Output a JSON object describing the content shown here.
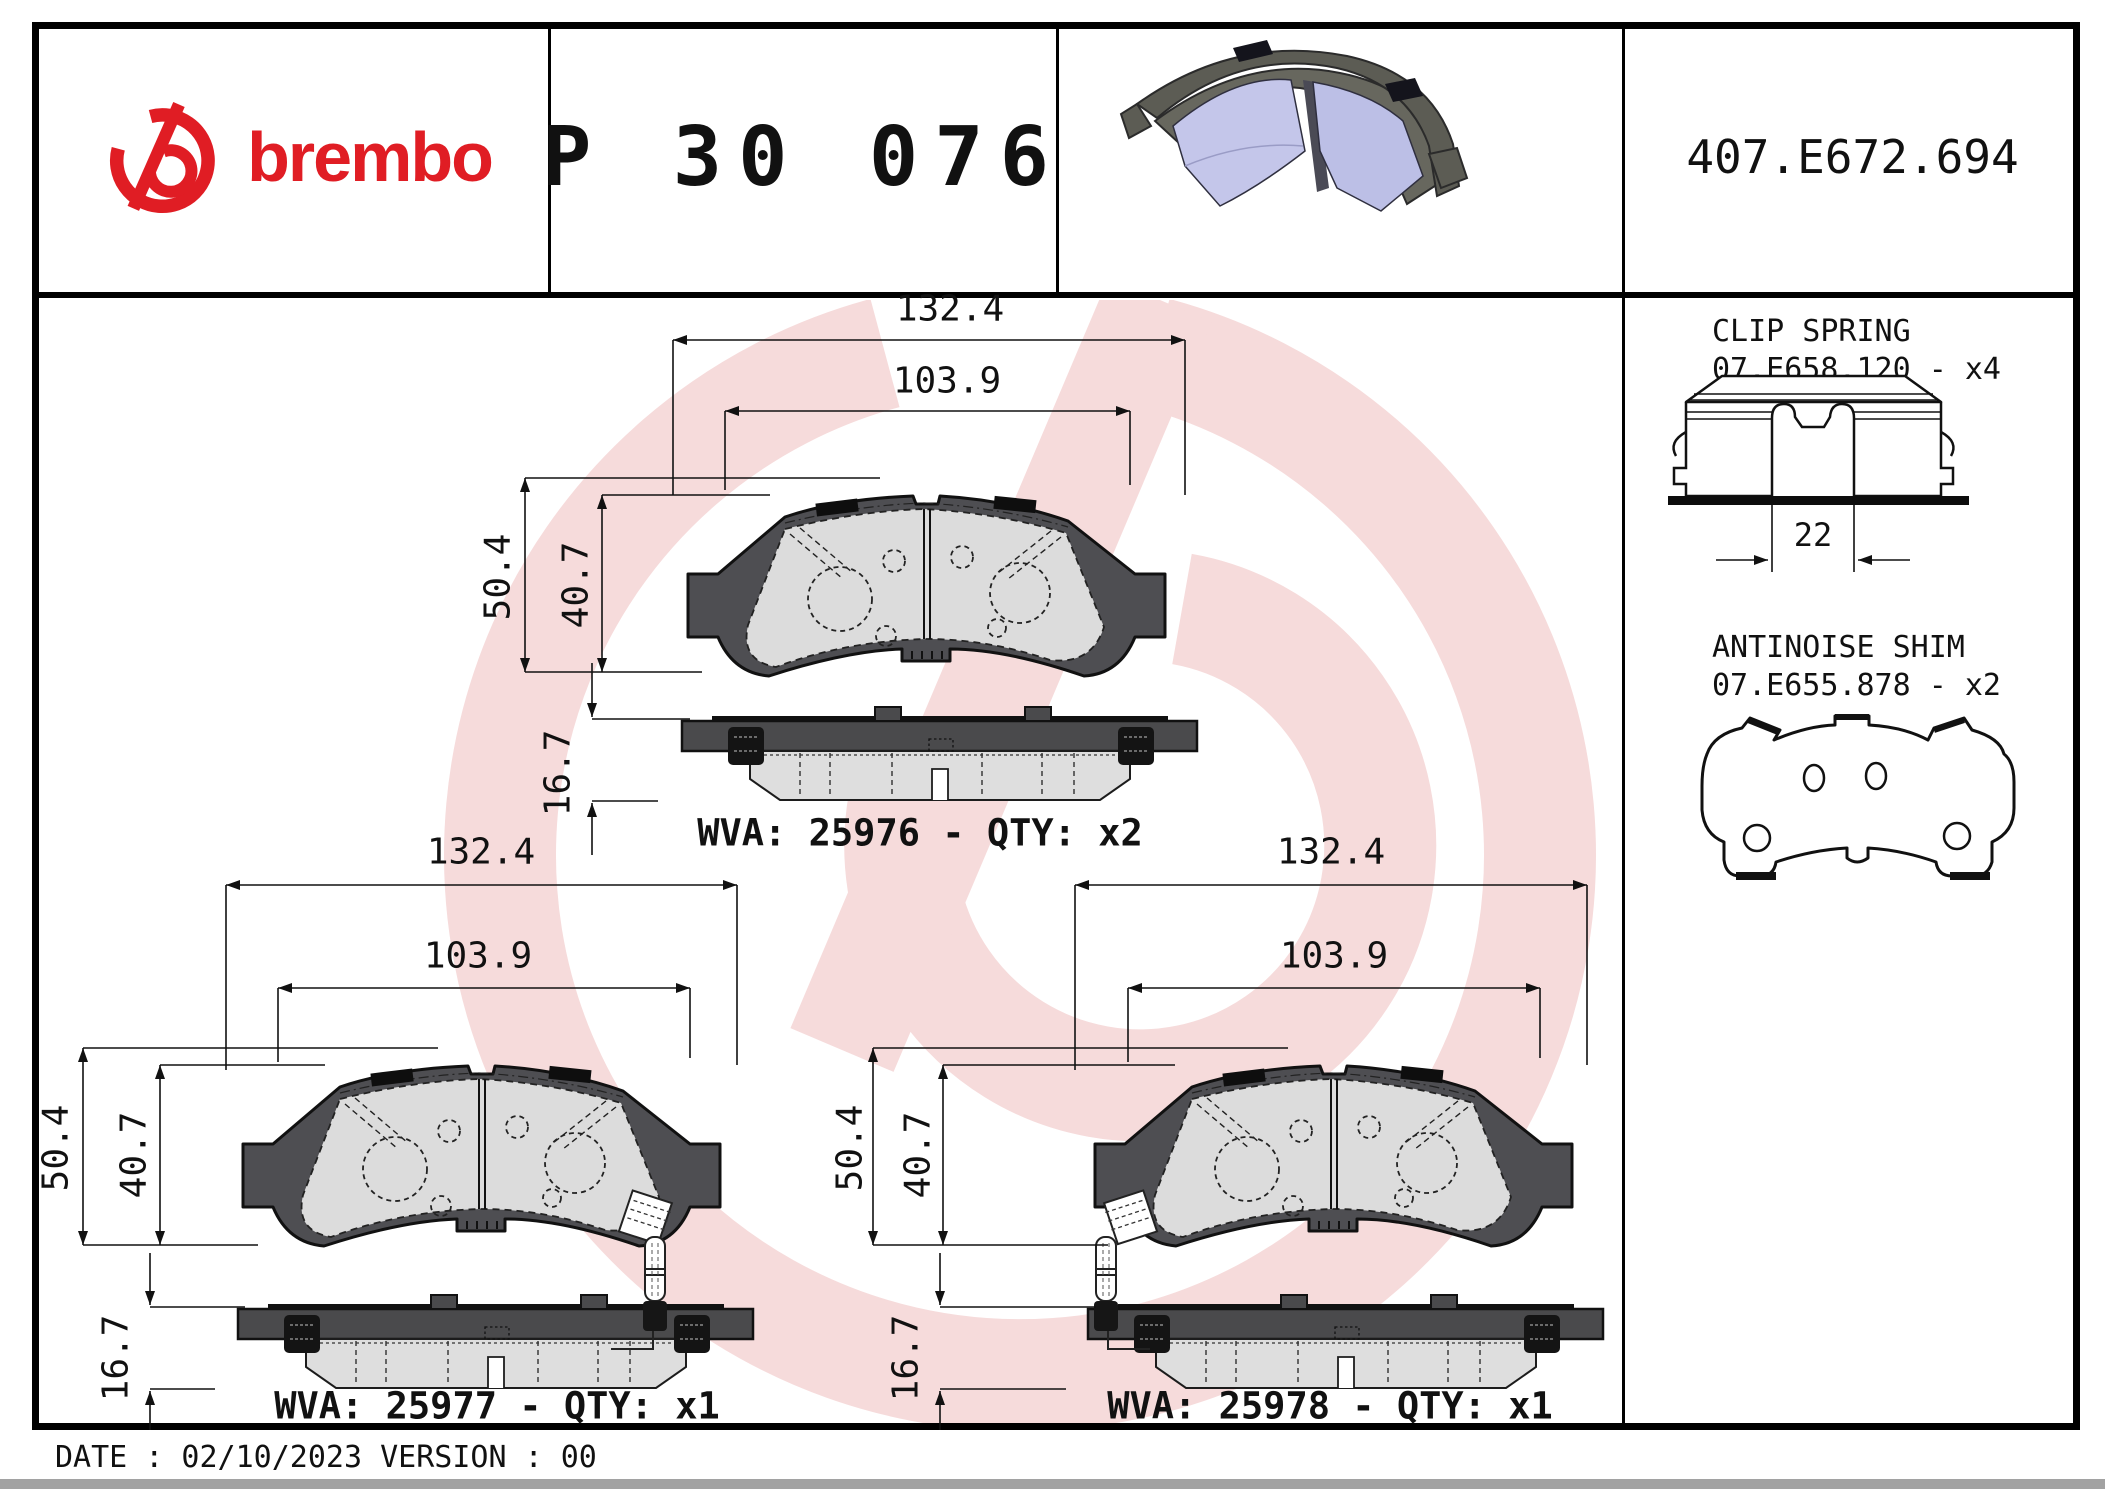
{
  "header": {
    "brand_wordmark": "brembo",
    "part_number": "P 30 076",
    "catalog_code": "407.E672.694"
  },
  "sidebar": {
    "clip_spring": {
      "title": "CLIP SPRING",
      "code": "07.E658.120 - x4",
      "slot_width": "22"
    },
    "antinoise_shim": {
      "title": "ANTINOISE SHIM",
      "code": "07.E655.878 - x2"
    }
  },
  "figures": [
    {
      "wva": "WVA: 25976 - QTY: x2",
      "width_total": "132.4",
      "width_pad": "103.9",
      "height_total": "50.4",
      "height_pad": "40.7",
      "thickness": "16.7"
    },
    {
      "wva": "WVA: 25977 - QTY: x1",
      "width_total": "132.4",
      "width_pad": "103.9",
      "height_total": "50.4",
      "height_pad": "40.7",
      "thickness": "16.7"
    },
    {
      "wva": "WVA: 25978 - QTY: x1",
      "width_total": "132.4",
      "width_pad": "103.9",
      "height_total": "50.4",
      "height_pad": "40.7",
      "thickness": "16.7"
    }
  ],
  "footer": {
    "date_version": "DATE : 02/10/2023 VERSION : 00"
  },
  "colors": {
    "accent_red": "#e01d24",
    "watermark_pink": "#f6dbdb",
    "backplate_gray": "#4e4e52",
    "friction_gray": "#dcdcdc",
    "pad_3d_lavender": "#c4c6ea"
  }
}
